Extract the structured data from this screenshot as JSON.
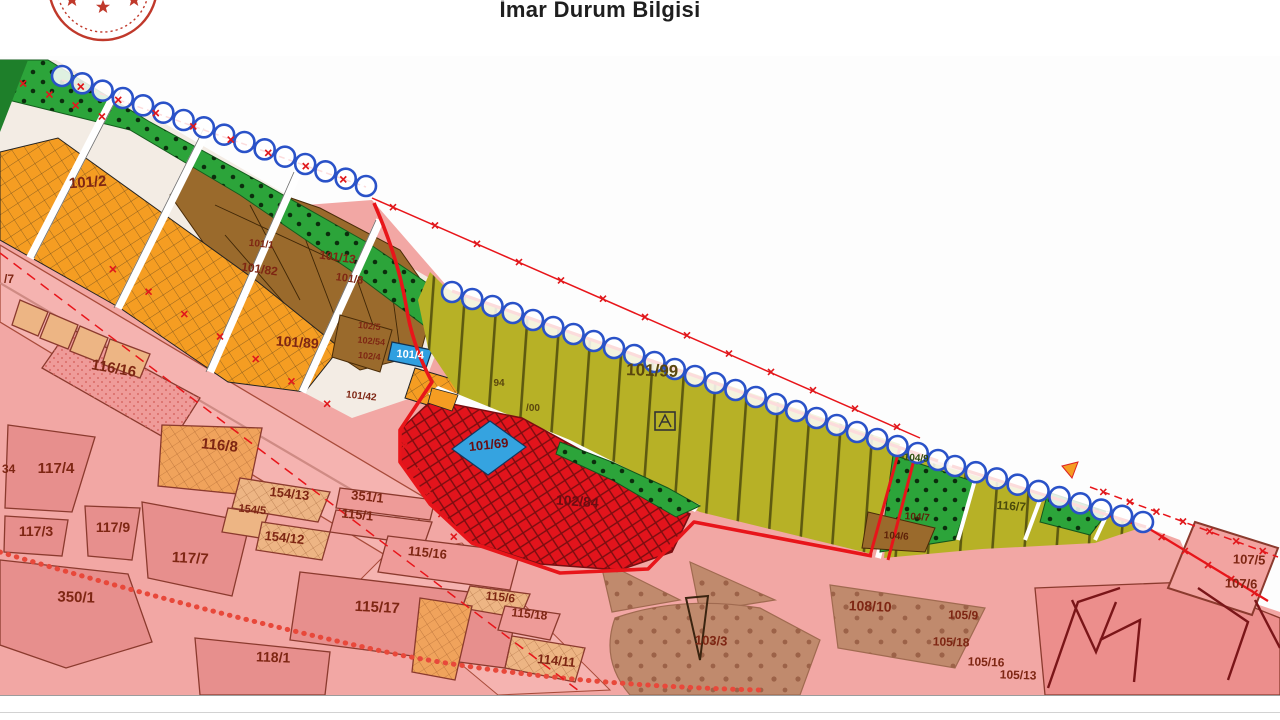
{
  "header": {
    "title": "İmar Durum Bilgisi",
    "logo": "government-seal-partial"
  },
  "map": {
    "type": "zoning-plan",
    "legend_colors": {
      "residential_pink": "#f2a7a4",
      "parcel_dark_pink": "#e78f8d",
      "commercial_orange_grid": "#f59d22",
      "green_park_dotted": "#2ca43a",
      "brown_zone": "#9a6a2c",
      "olive_striped_zone": "#b7b126",
      "red_crosshatch_zone": "#e2141c",
      "blue_parcel": "#35a3e0",
      "tan_open_area": "#c08a6d",
      "boundary_circle_chain": "#2a52c8",
      "plan_boundary_red": "#e8151a"
    },
    "labels": [
      {
        "text": "101/2",
        "x": 88,
        "y": 187,
        "size": 15,
        "color": "#7e2613",
        "rot": -4
      },
      {
        "text": "101/1",
        "x": 261,
        "y": 247,
        "size": 10,
        "color": "#7e2613",
        "rot": 6
      },
      {
        "text": "101/13",
        "x": 337,
        "y": 261,
        "size": 12,
        "color": "#7e2613",
        "rot": 8
      },
      {
        "text": "101/82",
        "x": 259,
        "y": 273,
        "size": 12,
        "color": "#7e2613",
        "rot": 8
      },
      {
        "text": "101/8",
        "x": 349,
        "y": 282,
        "size": 11,
        "color": "#7e2613",
        "rot": 8
      },
      {
        "text": "101/89",
        "x": 297,
        "y": 347,
        "size": 14,
        "color": "#7e2613",
        "rot": 4
      },
      {
        "text": "102/5",
        "x": 369,
        "y": 329,
        "size": 9,
        "color": "#7e2613",
        "rot": 6
      },
      {
        "text": "102/54",
        "x": 371,
        "y": 344,
        "size": 9,
        "color": "#7e2613",
        "rot": 6
      },
      {
        "text": "102/4",
        "x": 369,
        "y": 359,
        "size": 9,
        "color": "#7e2613",
        "rot": 6
      },
      {
        "text": "101/4",
        "x": 410,
        "y": 358,
        "size": 11,
        "color": "#ffffff",
        "rot": 4
      },
      {
        "text": "101/42",
        "x": 361,
        "y": 399,
        "size": 10,
        "color": "#7e2613",
        "rot": 6
      },
      {
        "text": "101/99",
        "x": 652,
        "y": 376,
        "size": 17,
        "color": "#5a470e",
        "rot": 2
      },
      {
        "text": "94",
        "x": 499,
        "y": 386,
        "size": 10,
        "color": "#5a470e",
        "rot": 0
      },
      {
        "text": "/00",
        "x": 533,
        "y": 411,
        "size": 10,
        "color": "#5a470e",
        "rot": 0
      },
      {
        "text": "104/9",
        "x": 916,
        "y": 461,
        "size": 10,
        "color": "#2f4d0c",
        "rot": 4
      },
      {
        "text": "104/7",
        "x": 917,
        "y": 520,
        "size": 10,
        "color": "#5e2108",
        "rot": 4
      },
      {
        "text": "104/6",
        "x": 896,
        "y": 539,
        "size": 10,
        "color": "#5e2108",
        "rot": 4
      },
      {
        "text": "116/7",
        "x": 1011,
        "y": 510,
        "size": 12,
        "color": "#4a4a0c",
        "rot": 4
      },
      {
        "text": "101/69",
        "x": 489,
        "y": 449,
        "size": 13,
        "color": "#6b0d12",
        "rot": -6
      },
      {
        "text": "102/84",
        "x": 577,
        "y": 506,
        "size": 14,
        "color": "#6b0d12",
        "rot": 4
      },
      {
        "text": "/7",
        "x": 4,
        "y": 283,
        "size": 12,
        "color": "#7e2613",
        "rot": 0,
        "anchor": "start"
      },
      {
        "text": "116/16",
        "x": 113,
        "y": 373,
        "size": 15,
        "color": "#7e2613",
        "rot": 10
      },
      {
        "text": "116/8",
        "x": 219,
        "y": 450,
        "size": 15,
        "color": "#7e2613",
        "rot": 6
      },
      {
        "text": "34",
        "x": 2,
        "y": 473,
        "size": 12,
        "color": "#7e2613",
        "rot": 0,
        "anchor": "start"
      },
      {
        "text": "117/4",
        "x": 56,
        "y": 473,
        "size": 15,
        "color": "#7e2613",
        "rot": 0
      },
      {
        "text": "117/3",
        "x": 36,
        "y": 536,
        "size": 14,
        "color": "#7e2613",
        "rot": 0
      },
      {
        "text": "117/9",
        "x": 113,
        "y": 532,
        "size": 14,
        "color": "#7e2613",
        "rot": 0
      },
      {
        "text": "117/7",
        "x": 190,
        "y": 563,
        "size": 15,
        "color": "#7e2613",
        "rot": 3
      },
      {
        "text": "350/1",
        "x": 76,
        "y": 602,
        "size": 15,
        "color": "#7e2613",
        "rot": 2
      },
      {
        "text": "154/13",
        "x": 289,
        "y": 498,
        "size": 13,
        "color": "#7e2613",
        "rot": 6
      },
      {
        "text": "154/5",
        "x": 252,
        "y": 513,
        "size": 11,
        "color": "#7e2613",
        "rot": 6
      },
      {
        "text": "154/12",
        "x": 284,
        "y": 542,
        "size": 13,
        "color": "#7e2613",
        "rot": 6
      },
      {
        "text": "351/1",
        "x": 367,
        "y": 501,
        "size": 13,
        "color": "#7e2613",
        "rot": 6
      },
      {
        "text": "115/1",
        "x": 357,
        "y": 519,
        "size": 13,
        "color": "#7e2613",
        "rot": 6
      },
      {
        "text": "115/16",
        "x": 427,
        "y": 557,
        "size": 13,
        "color": "#7e2613",
        "rot": 6
      },
      {
        "text": "115/17",
        "x": 377,
        "y": 612,
        "size": 15,
        "color": "#7e2613",
        "rot": 3
      },
      {
        "text": "118/1",
        "x": 273,
        "y": 662,
        "size": 14,
        "color": "#7e2613",
        "rot": 2
      },
      {
        "text": "115/6",
        "x": 500,
        "y": 601,
        "size": 12,
        "color": "#7e2613",
        "rot": 6
      },
      {
        "text": "115/18",
        "x": 529,
        "y": 618,
        "size": 12,
        "color": "#7e2613",
        "rot": 6
      },
      {
        "text": "114/11",
        "x": 556,
        "y": 665,
        "size": 13,
        "color": "#7e2613",
        "rot": 6
      },
      {
        "text": "103/3",
        "x": 711,
        "y": 645,
        "size": 13,
        "color": "#7e2613",
        "rot": 2
      },
      {
        "text": "108/10",
        "x": 870,
        "y": 611,
        "size": 14,
        "color": "#7e2613",
        "rot": 2
      },
      {
        "text": "105/9",
        "x": 963,
        "y": 619,
        "size": 12,
        "color": "#7e2613",
        "rot": 2
      },
      {
        "text": "105/18",
        "x": 951,
        "y": 646,
        "size": 12,
        "color": "#7e2613",
        "rot": 2
      },
      {
        "text": "105/16",
        "x": 986,
        "y": 666,
        "size": 12,
        "color": "#7e2613",
        "rot": 2
      },
      {
        "text": "105/13",
        "x": 1018,
        "y": 679,
        "size": 12,
        "color": "#7e2613",
        "rot": 2
      },
      {
        "text": "107/5",
        "x": 1249,
        "y": 564,
        "size": 13,
        "color": "#7e2613",
        "rot": 2
      },
      {
        "text": "107/6",
        "x": 1241,
        "y": 588,
        "size": 13,
        "color": "#7e2613",
        "rot": 2
      }
    ]
  }
}
